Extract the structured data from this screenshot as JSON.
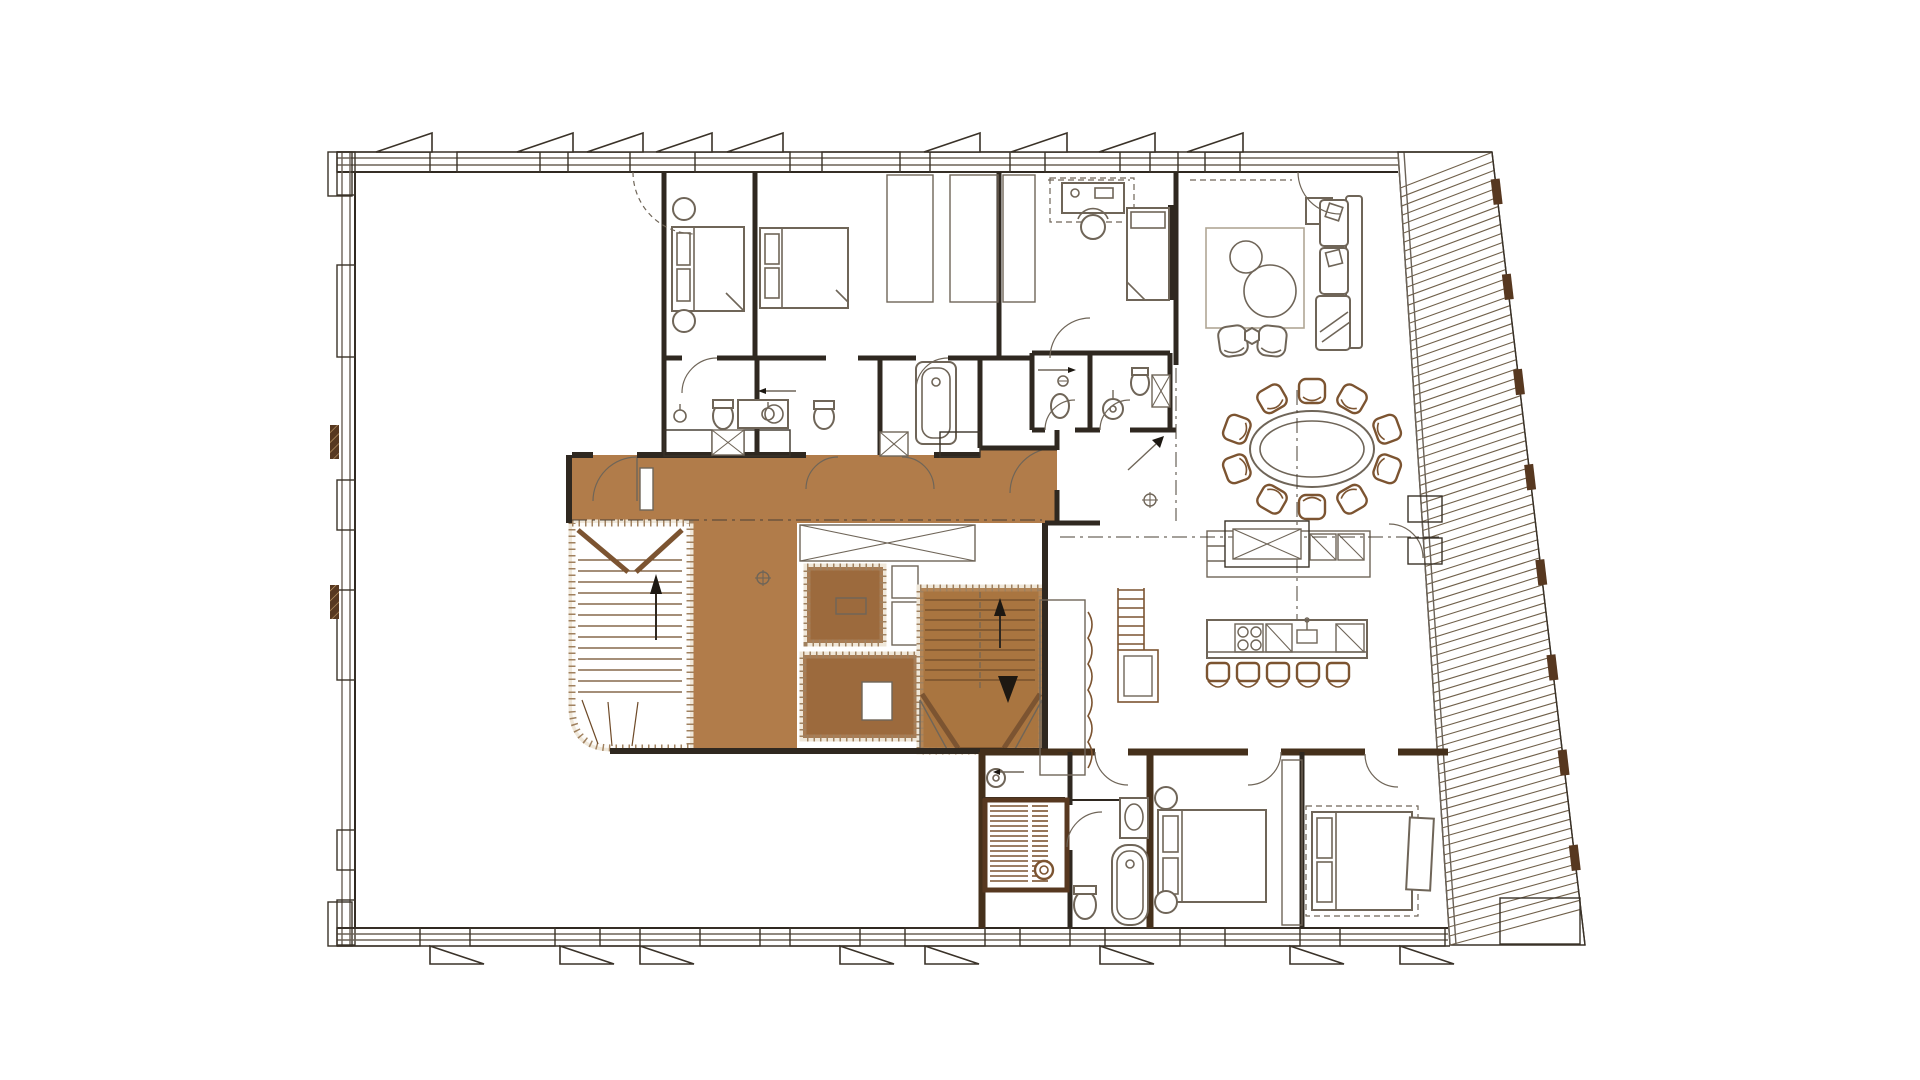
{
  "drawing": {
    "kind": "apartment-floor-plan",
    "visible_text": "none",
    "features": [
      "vacant-open-space",
      "bedroom-1",
      "bedroom-2",
      "study",
      "living-room",
      "bathrooms",
      "entrance-hall",
      "highlighted-corridor",
      "core-storage-rooms",
      "stairwell-left",
      "staircase-right",
      "dining-area-oval-table",
      "sideboard-counter",
      "kitchen-island",
      "sauna",
      "bath-suite",
      "bedroom-3",
      "bedroom-4",
      "slanted-terrace-decking"
    ],
    "counts": {
      "dining_chairs": 10,
      "bar_stools": 5,
      "awning_flags_top": 9,
      "awning_flags_bottom": 8
    }
  },
  "colors": {
    "bg": "#ffffff",
    "wall_dark": "#573820",
    "wall_hatch_line": "#caa36f",
    "wall_edge": "#3a3228",
    "partition": "#2f2820",
    "suite_wall": "#45301b",
    "glazing": "#6b6257",
    "corridor_fill": "#b17c4a",
    "core_room_fill": "#9c6a3d",
    "stair_fill": "#a97540",
    "stair_line": "#6e4a28",
    "core_band": "#efe7d9",
    "core_dots": "#93704a",
    "furniture_line": "#6f6558",
    "furniture_brown": "#7c5431",
    "fixture_line": "#6f6558",
    "deck_line": "#70604a",
    "reference_line": "#4a4136",
    "arrow": "#1d1812",
    "rug": "#b0a695",
    "hatch_gray": "#8d8376"
  },
  "geom": {
    "top_wall": {
      "y1": 152,
      "y2": 172,
      "x1": 337,
      "x2": 1398,
      "segments": [
        [
          337,
          430
        ],
        [
          457,
          540
        ],
        [
          568,
          630
        ],
        [
          695,
          790
        ],
        [
          822,
          900
        ],
        [
          930,
          1010
        ],
        [
          1045,
          1120
        ],
        [
          1150,
          1178
        ],
        [
          1205,
          1240
        ]
      ]
    },
    "left_wall": {
      "x1": 337,
      "x2": 355,
      "y1": 152,
      "y2": 945,
      "segments": [
        [
          152,
          195
        ],
        [
          265,
          357
        ],
        [
          480,
          530
        ],
        [
          590,
          680
        ],
        [
          830,
          870
        ],
        [
          900,
          945
        ]
      ]
    },
    "bottom_wall": {
      "y1": 928,
      "y2": 946,
      "x1": 337,
      "x2": 1448,
      "segments": [
        [
          337,
          420
        ],
        [
          470,
          555
        ],
        [
          600,
          640
        ],
        [
          700,
          760
        ],
        [
          790,
          860
        ],
        [
          905,
          985
        ],
        [
          1020,
          1070
        ],
        [
          1105,
          1180
        ],
        [
          1225,
          1300
        ],
        [
          1340,
          1445
        ]
      ]
    },
    "flags_top": [
      432,
      573,
      643,
      712,
      783,
      980,
      1067,
      1155,
      1243
    ],
    "flags_bottom": [
      430,
      560,
      640,
      840,
      925,
      1100,
      1290,
      1400
    ],
    "terrace": {
      "inner": [
        1398,
        152,
        1450,
        945
      ],
      "outer": [
        1492,
        152,
        1585,
        945
      ],
      "deck_count": 88,
      "deck_lead": 0.045,
      "posts_t": [
        0.05,
        0.17,
        0.29,
        0.41,
        0.53,
        0.65,
        0.77,
        0.89
      ]
    },
    "stair_left_treads": {
      "x1": 578,
      "x2": 682,
      "y_start": 560,
      "y_end": 698,
      "step": 11
    },
    "stair_right_treads": {
      "x1": 925,
      "x2": 1035,
      "y_start": 600,
      "y_end": 688,
      "step": 10
    },
    "dining_chairs": {
      "cx": 1312,
      "cy": 449,
      "rx": 80,
      "ry": 58,
      "angles_deg": [
        -120,
        -90,
        -60,
        -20,
        20,
        60,
        90,
        120,
        160,
        200
      ]
    },
    "bar_stools": {
      "xs": [
        1218,
        1248,
        1278,
        1308,
        1338
      ],
      "y": 672
    },
    "sauna_slats": [
      {
        "x1": 990,
        "x2": 1028,
        "y1": 806,
        "y2": 884,
        "step": 5
      },
      {
        "x1": 1032,
        "x2": 1048,
        "y1": 806,
        "y2": 884,
        "step": 5
      }
    ],
    "ladder_rungs": {
      "x1": 1118,
      "x2": 1144,
      "y_start": 590,
      "y_end": 646,
      "step": 9
    },
    "wardrobes": [
      [
        887,
        175,
        46,
        127
      ],
      [
        950,
        175,
        48,
        127
      ],
      [
        1003,
        175,
        32,
        127
      ],
      [
        1040,
        600,
        45,
        175
      ],
      [
        1282,
        760,
        20,
        165
      ]
    ],
    "x_boxes": [
      [
        712,
        430,
        32,
        25
      ],
      [
        880,
        432,
        28,
        24
      ],
      [
        1152,
        375,
        18,
        32
      ],
      [
        1233,
        529,
        68,
        30
      ],
      [
        800,
        525,
        175,
        36
      ]
    ],
    "hatch_blocks": [
      [
        664,
        430,
        48,
        26
      ],
      [
        744,
        430,
        46,
        26
      ],
      [
        940,
        432,
        40,
        25
      ],
      [
        1408,
        496,
        34,
        26
      ],
      [
        1408,
        538,
        34,
        26
      ],
      [
        1500,
        898,
        80,
        46
      ]
    ]
  }
}
